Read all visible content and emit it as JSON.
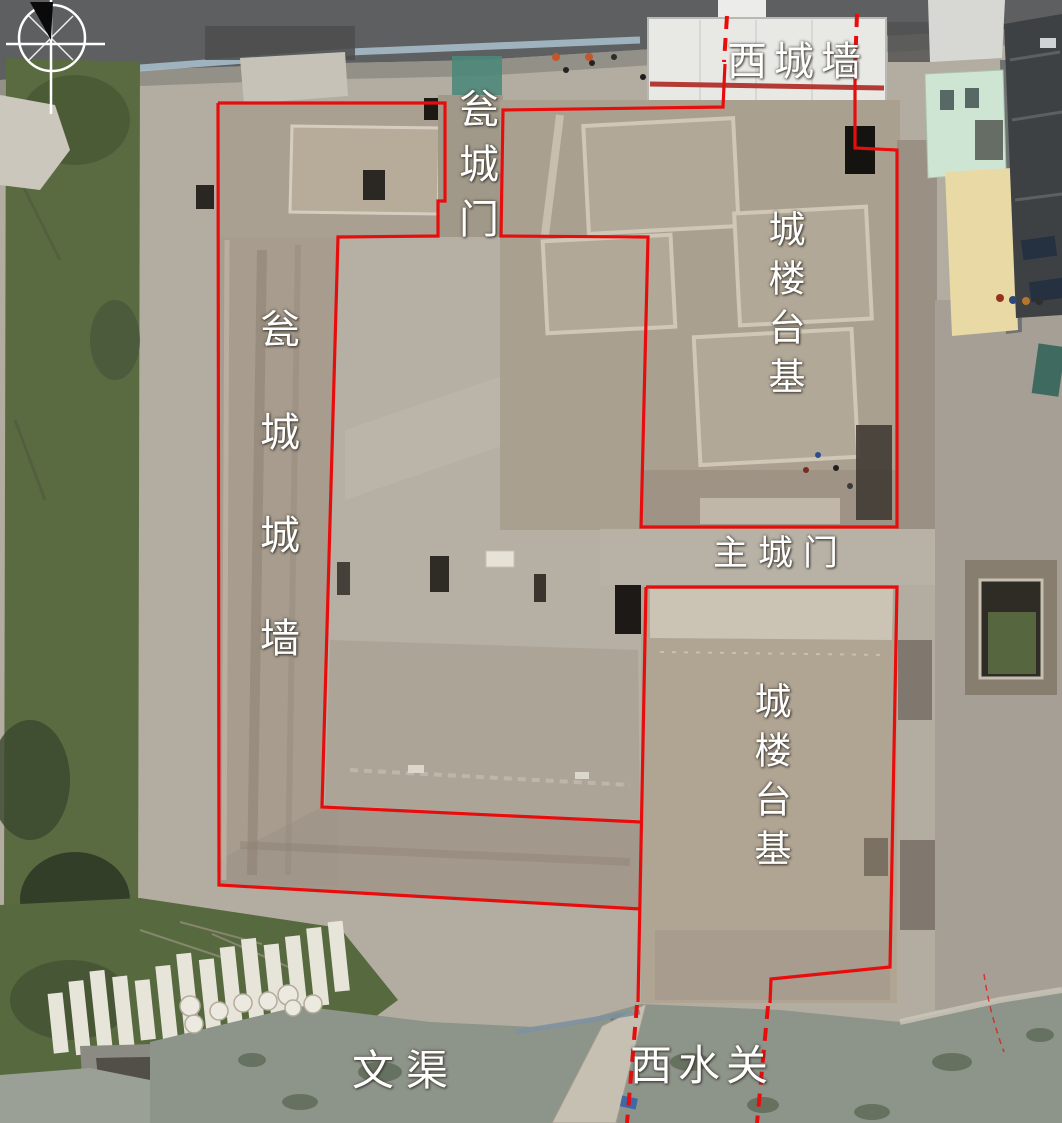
{
  "figure": {
    "kind": "annotated-aerial-photograph",
    "annotation_line_color": "#e80d0d",
    "label_text_color": "#ffffff"
  },
  "labels": {
    "west_city_wall": {
      "text": "西城墙",
      "orientation": "horizontal"
    },
    "barbican_gate": {
      "text": "瓮城门",
      "orientation": "vertical"
    },
    "gate_tower_platform_north": {
      "text": "城楼台基",
      "orientation": "vertical"
    },
    "barbican_wall": {
      "text": "瓮城城墙",
      "orientation": "vertical"
    },
    "main_city_gate": {
      "text": "主城门",
      "orientation": "horizontal"
    },
    "gate_tower_platform_south": {
      "text": "城楼台基",
      "orientation": "vertical"
    },
    "wen_canal": {
      "text": "文渠",
      "orientation": "horizontal"
    },
    "west_water_gate": {
      "text": "西水关",
      "orientation": "horizontal"
    }
  },
  "icons": {
    "compass": "compass-north-arrow"
  }
}
